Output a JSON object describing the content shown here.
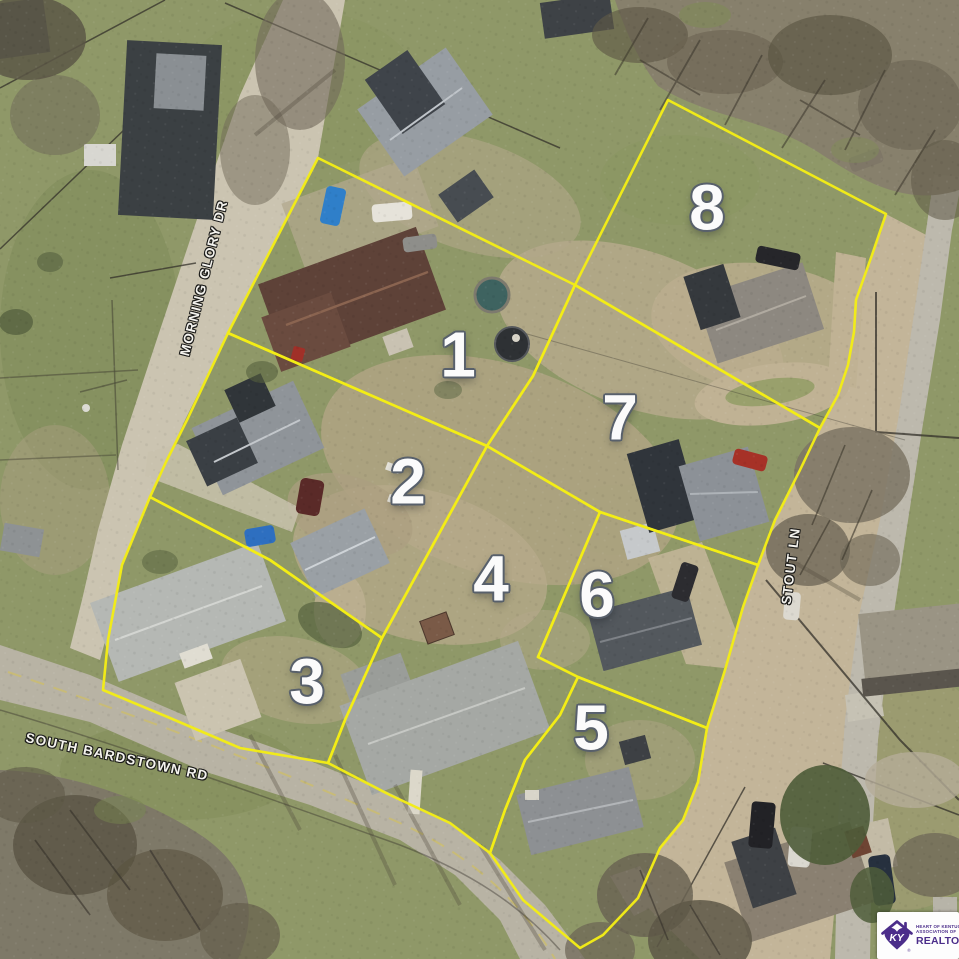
{
  "map": {
    "overlay_color": "#f3ec16",
    "number_color": "#fbfbfb",
    "street_label_color": "#f4f3ee",
    "parcels": [
      {
        "number": "1",
        "label_x": 458,
        "label_y": 357,
        "points": "318,158 575,285 533,376 487,446 228,333"
      },
      {
        "number": "2",
        "label_x": 408,
        "label_y": 484,
        "points": "228,333 487,446 382,638 270,560 150,497 166,462 188,418"
      },
      {
        "number": "3",
        "label_x": 307,
        "label_y": 684,
        "points": "150,497 270,560 382,638 345,720 328,763 240,748 170,718 103,690 108,640 122,565"
      },
      {
        "number": "4",
        "label_x": 491,
        "label_y": 581,
        "points": "487,446 600,512 538,657 578,677 560,715 525,760 505,810 490,853 450,823 390,795 328,763 345,720 382,638"
      },
      {
        "number": "5",
        "label_x": 591,
        "label_y": 730,
        "points": "578,677 707,728 698,782 683,820 660,848 638,898 603,935 580,948 523,900 490,853 505,810 525,760 560,715"
      },
      {
        "number": "6",
        "label_x": 597,
        "label_y": 597,
        "points": "600,512 758,565 743,607 725,670 707,728 578,677 538,657"
      },
      {
        "number": "7",
        "label_x": 620,
        "label_y": 420,
        "points": "575,285 820,428 800,470 775,520 758,565 600,512 487,446 533,376"
      },
      {
        "number": "8",
        "label_x": 707,
        "label_y": 210,
        "points": "668,100 886,214 872,255 856,300 854,332 848,365 838,395 820,428 575,285"
      }
    ],
    "streets": [
      {
        "name": "MORNING GLORY DR",
        "x": 204,
        "y": 278,
        "rotation": -76
      },
      {
        "name": "SOUTH BARDSTOWN RD",
        "x": 117,
        "y": 757,
        "rotation": 12
      },
      {
        "name": "STOUT LN",
        "x": 791,
        "y": 566,
        "rotation": -83
      }
    ]
  },
  "logo": {
    "monogram": "KY",
    "line1": "HEART OF KENTUCKY",
    "line2": "ASSOCIATION OF",
    "line3": "REALTORS",
    "registered": "®",
    "brand_color": "#4b2d8a",
    "card_color": "#fdfdfd"
  }
}
